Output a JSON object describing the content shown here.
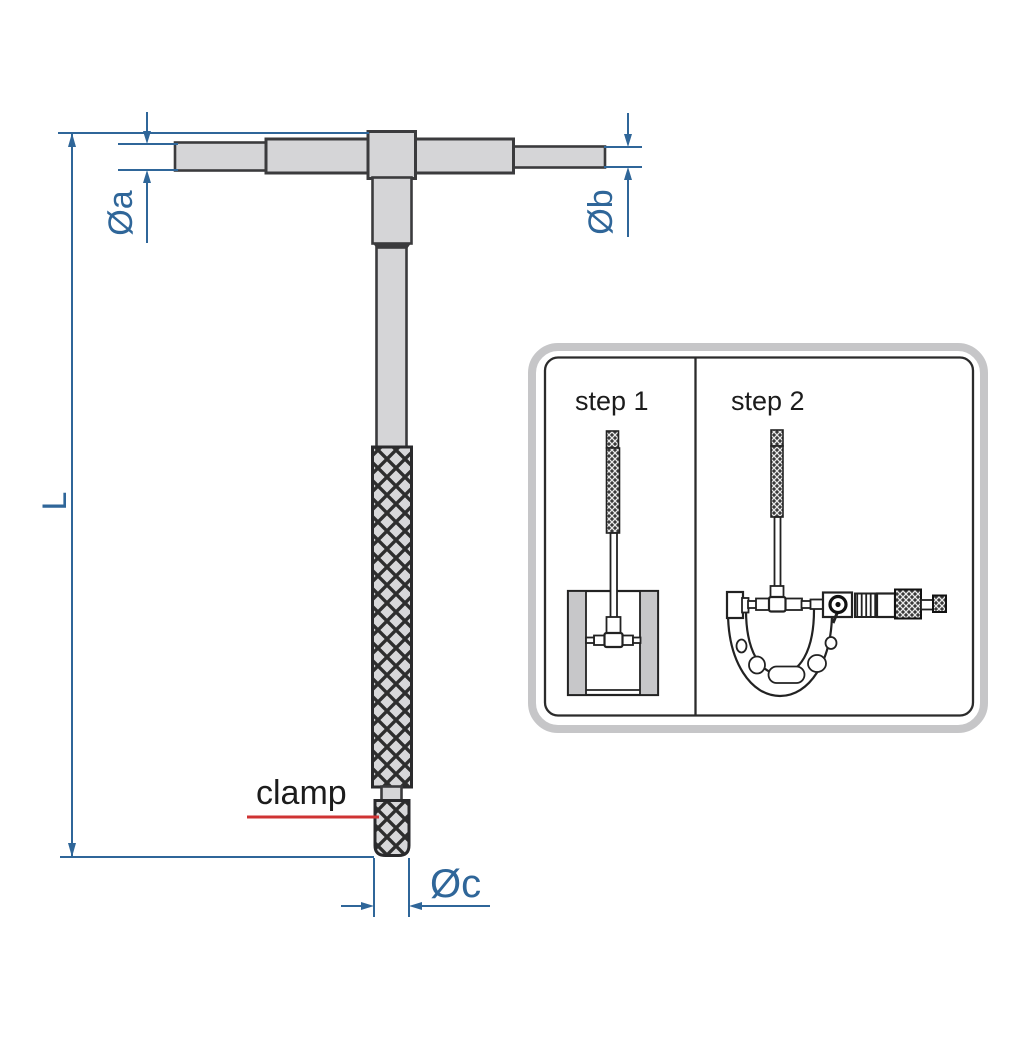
{
  "diagram": {
    "labels": {
      "dia_a": "Øa",
      "dia_b": "Øb",
      "dia_c": "Øc",
      "length": "L",
      "clamp": "clamp"
    },
    "inset": {
      "step1": "step 1",
      "step2": "step 2"
    },
    "colors": {
      "dimension_blue": "#2f6699",
      "clamp_red": "#cf3333",
      "body_gray": "#d5d5d7",
      "body_outline": "#3b3b3d",
      "knurl_dark": "#2a2a2c",
      "inset_border_gray": "#c6c6c8",
      "inset_inner_line": "#2b2b2b",
      "wall_gray": "#c7c7c9",
      "label_black": "#1c1c1c"
    }
  }
}
